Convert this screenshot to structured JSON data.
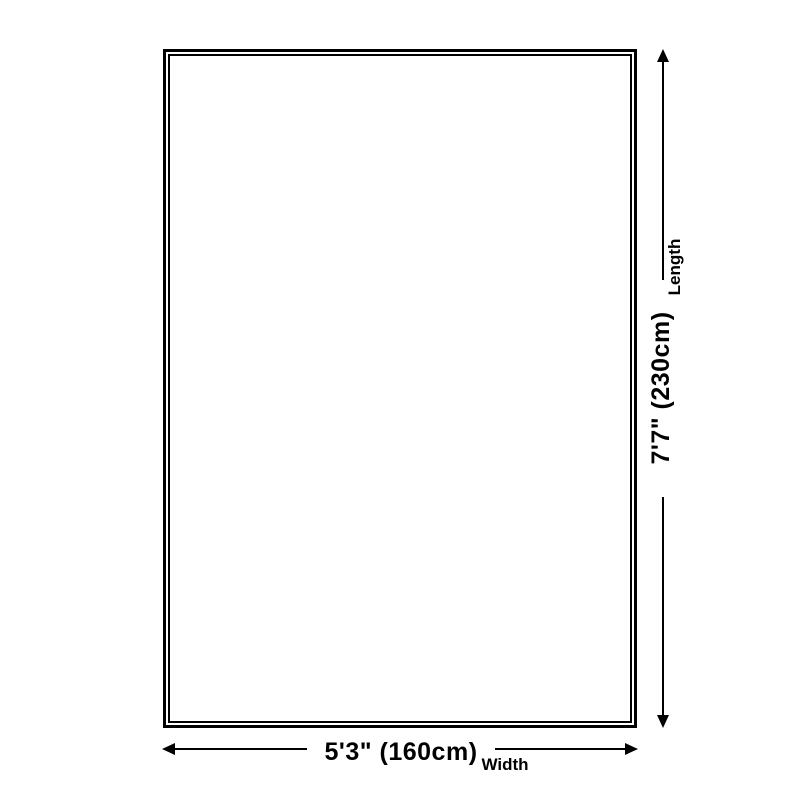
{
  "page": {
    "background_color": "#ffffff",
    "line_color": "#000000"
  },
  "diagram": {
    "shape": "rug-outline-rectangle",
    "width_dimension": {
      "value": "5'3\" (160cm)",
      "label": "Width"
    },
    "length_dimension": {
      "value": "7'7\" (230cm)",
      "label": "Length"
    }
  }
}
